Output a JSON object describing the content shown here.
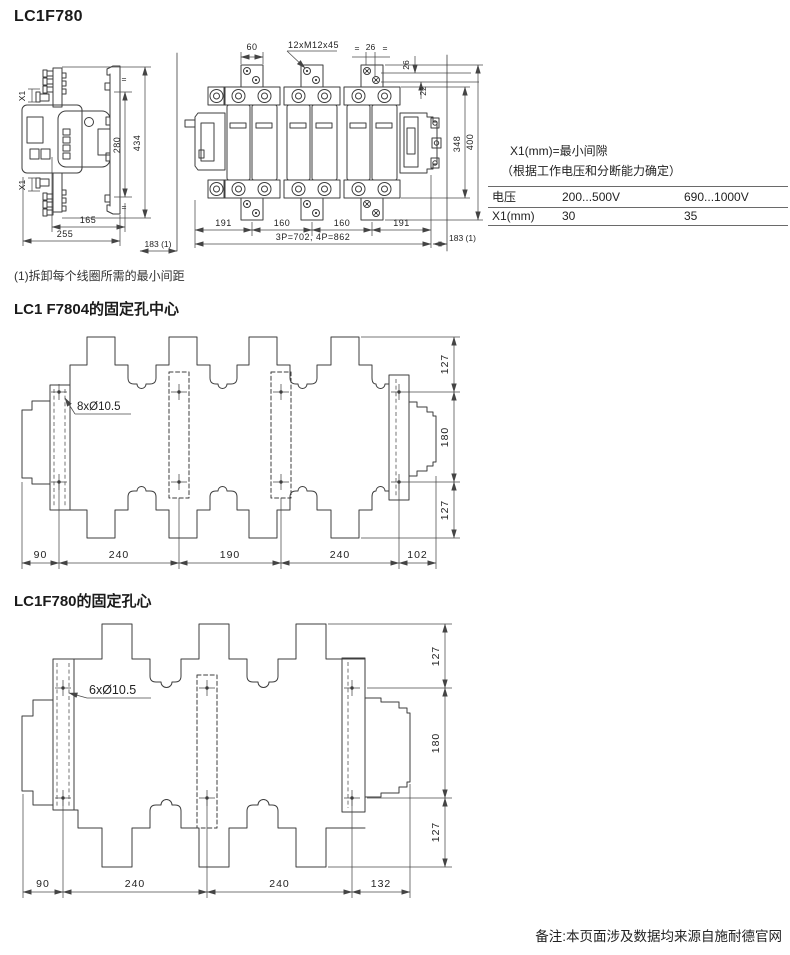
{
  "page": {
    "title": "LC1F780",
    "note1": "(1)拆卸每个线圈所需的最小间距",
    "footer": "备注:本页面涉及数据均来源自施耐德官网"
  },
  "side_view": {
    "x1_top": "X1",
    "x1_bottom": "X1",
    "eq_top": "=",
    "eq_bottom": "=",
    "height_inner": "280",
    "height_total": "434",
    "width_inner": "165",
    "width_total": "255",
    "clearance": "183 (1)"
  },
  "front_view": {
    "tab_width": "60",
    "screw_spec": "12xM12x45",
    "eq_left": "=",
    "pitch26": "26",
    "eq_right": "=",
    "v26": "26",
    "v22": "22",
    "height_inner": "348",
    "height_total": "400",
    "pitch_left": "191",
    "pitch_mid1": "160",
    "pitch_mid2": "160",
    "pitch_right": "191",
    "width_total": "3P=702, 4P=862",
    "clearance": "183 (1)"
  },
  "x1_table": {
    "note_line1": "X1(mm)=最小间隙",
    "note_line2": "（根据工作电压和分断能力确定）",
    "rows": [
      {
        "label": "电压",
        "v1": "200...500V",
        "v2": "690...1000V"
      },
      {
        "label": "X1(mm)",
        "v1": "30",
        "v2": "35"
      }
    ]
  },
  "f7804": {
    "title": "LC1 F7804的固定孔中心",
    "hole_label": "8xØ10.5",
    "bottom_dims": [
      "90",
      "240",
      "190",
      "240",
      "102"
    ],
    "right_dims": [
      "127",
      "180",
      "127"
    ]
  },
  "f780": {
    "title": "LC1F780的固定孔心",
    "hole_label": "6xØ10.5",
    "bottom_dims": [
      "90",
      "240",
      "240",
      "132"
    ],
    "right_dims": [
      "127",
      "180",
      "127"
    ]
  }
}
